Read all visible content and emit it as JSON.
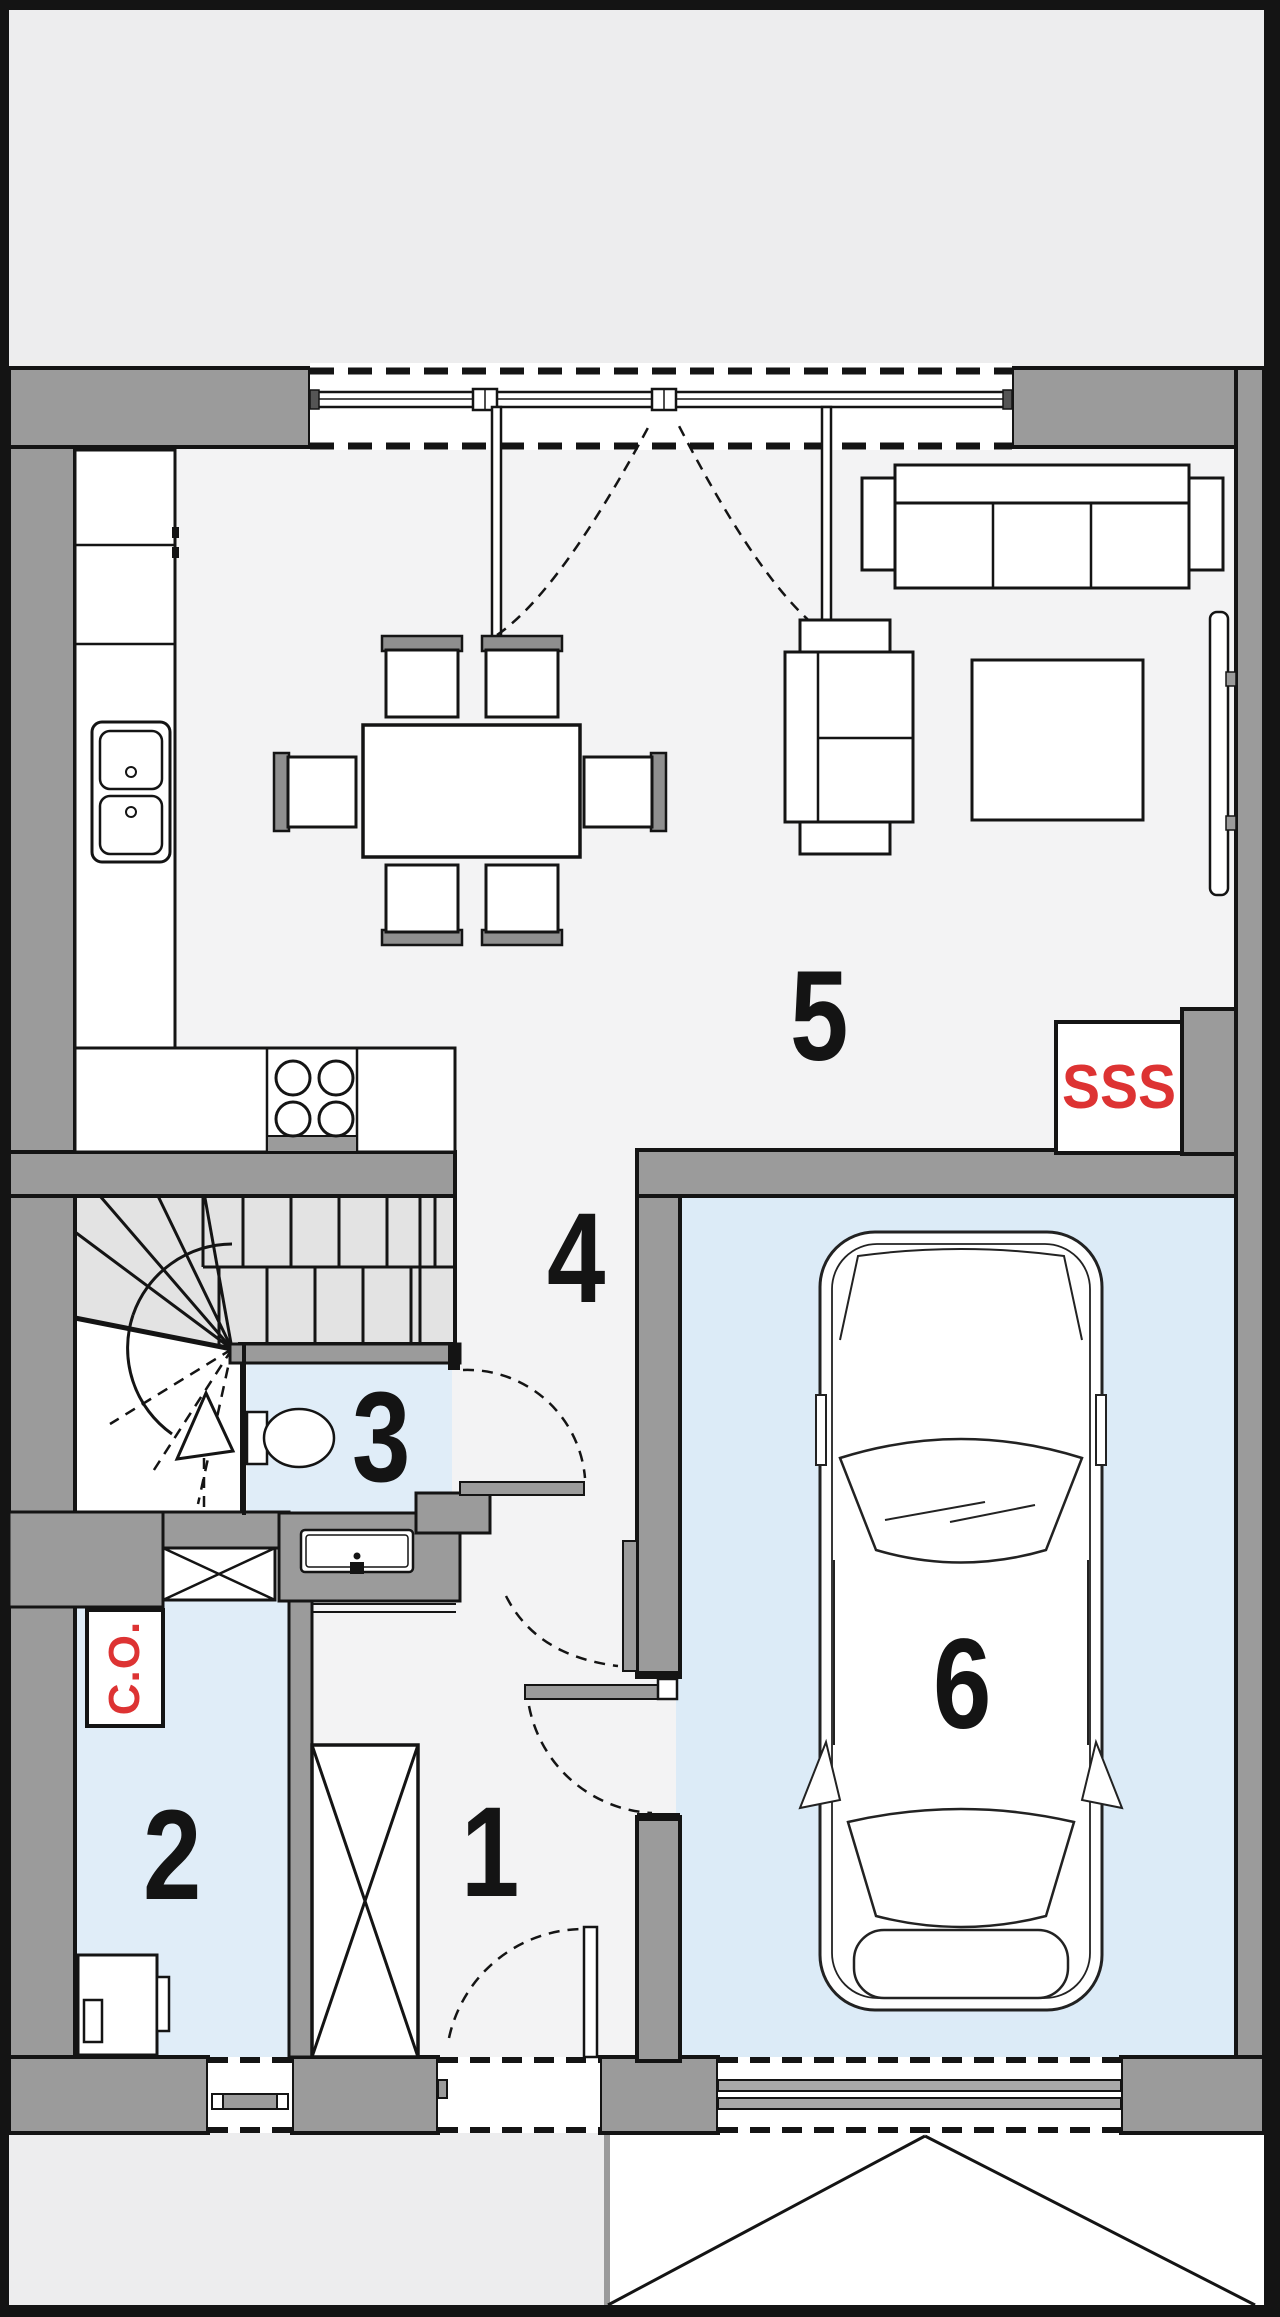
{
  "plan": {
    "rooms": [
      {
        "number": "1"
      },
      {
        "number": "2"
      },
      {
        "number": "3"
      },
      {
        "number": "4"
      },
      {
        "number": "5"
      },
      {
        "number": "6"
      }
    ],
    "annotations": {
      "boiler": "C.O.",
      "fireplace": "SSS"
    },
    "colors": {
      "wall": "#9b9b9b",
      "line": "#141414",
      "floor": "#f3f3f4",
      "wet_room_floor": "#e0edf8",
      "garage_floor": "#dcebf7",
      "stair_fill": "#e3e3e3",
      "exterior": "#ededee",
      "driveway": "#ffffff",
      "accent_red": "#dd3333"
    }
  }
}
